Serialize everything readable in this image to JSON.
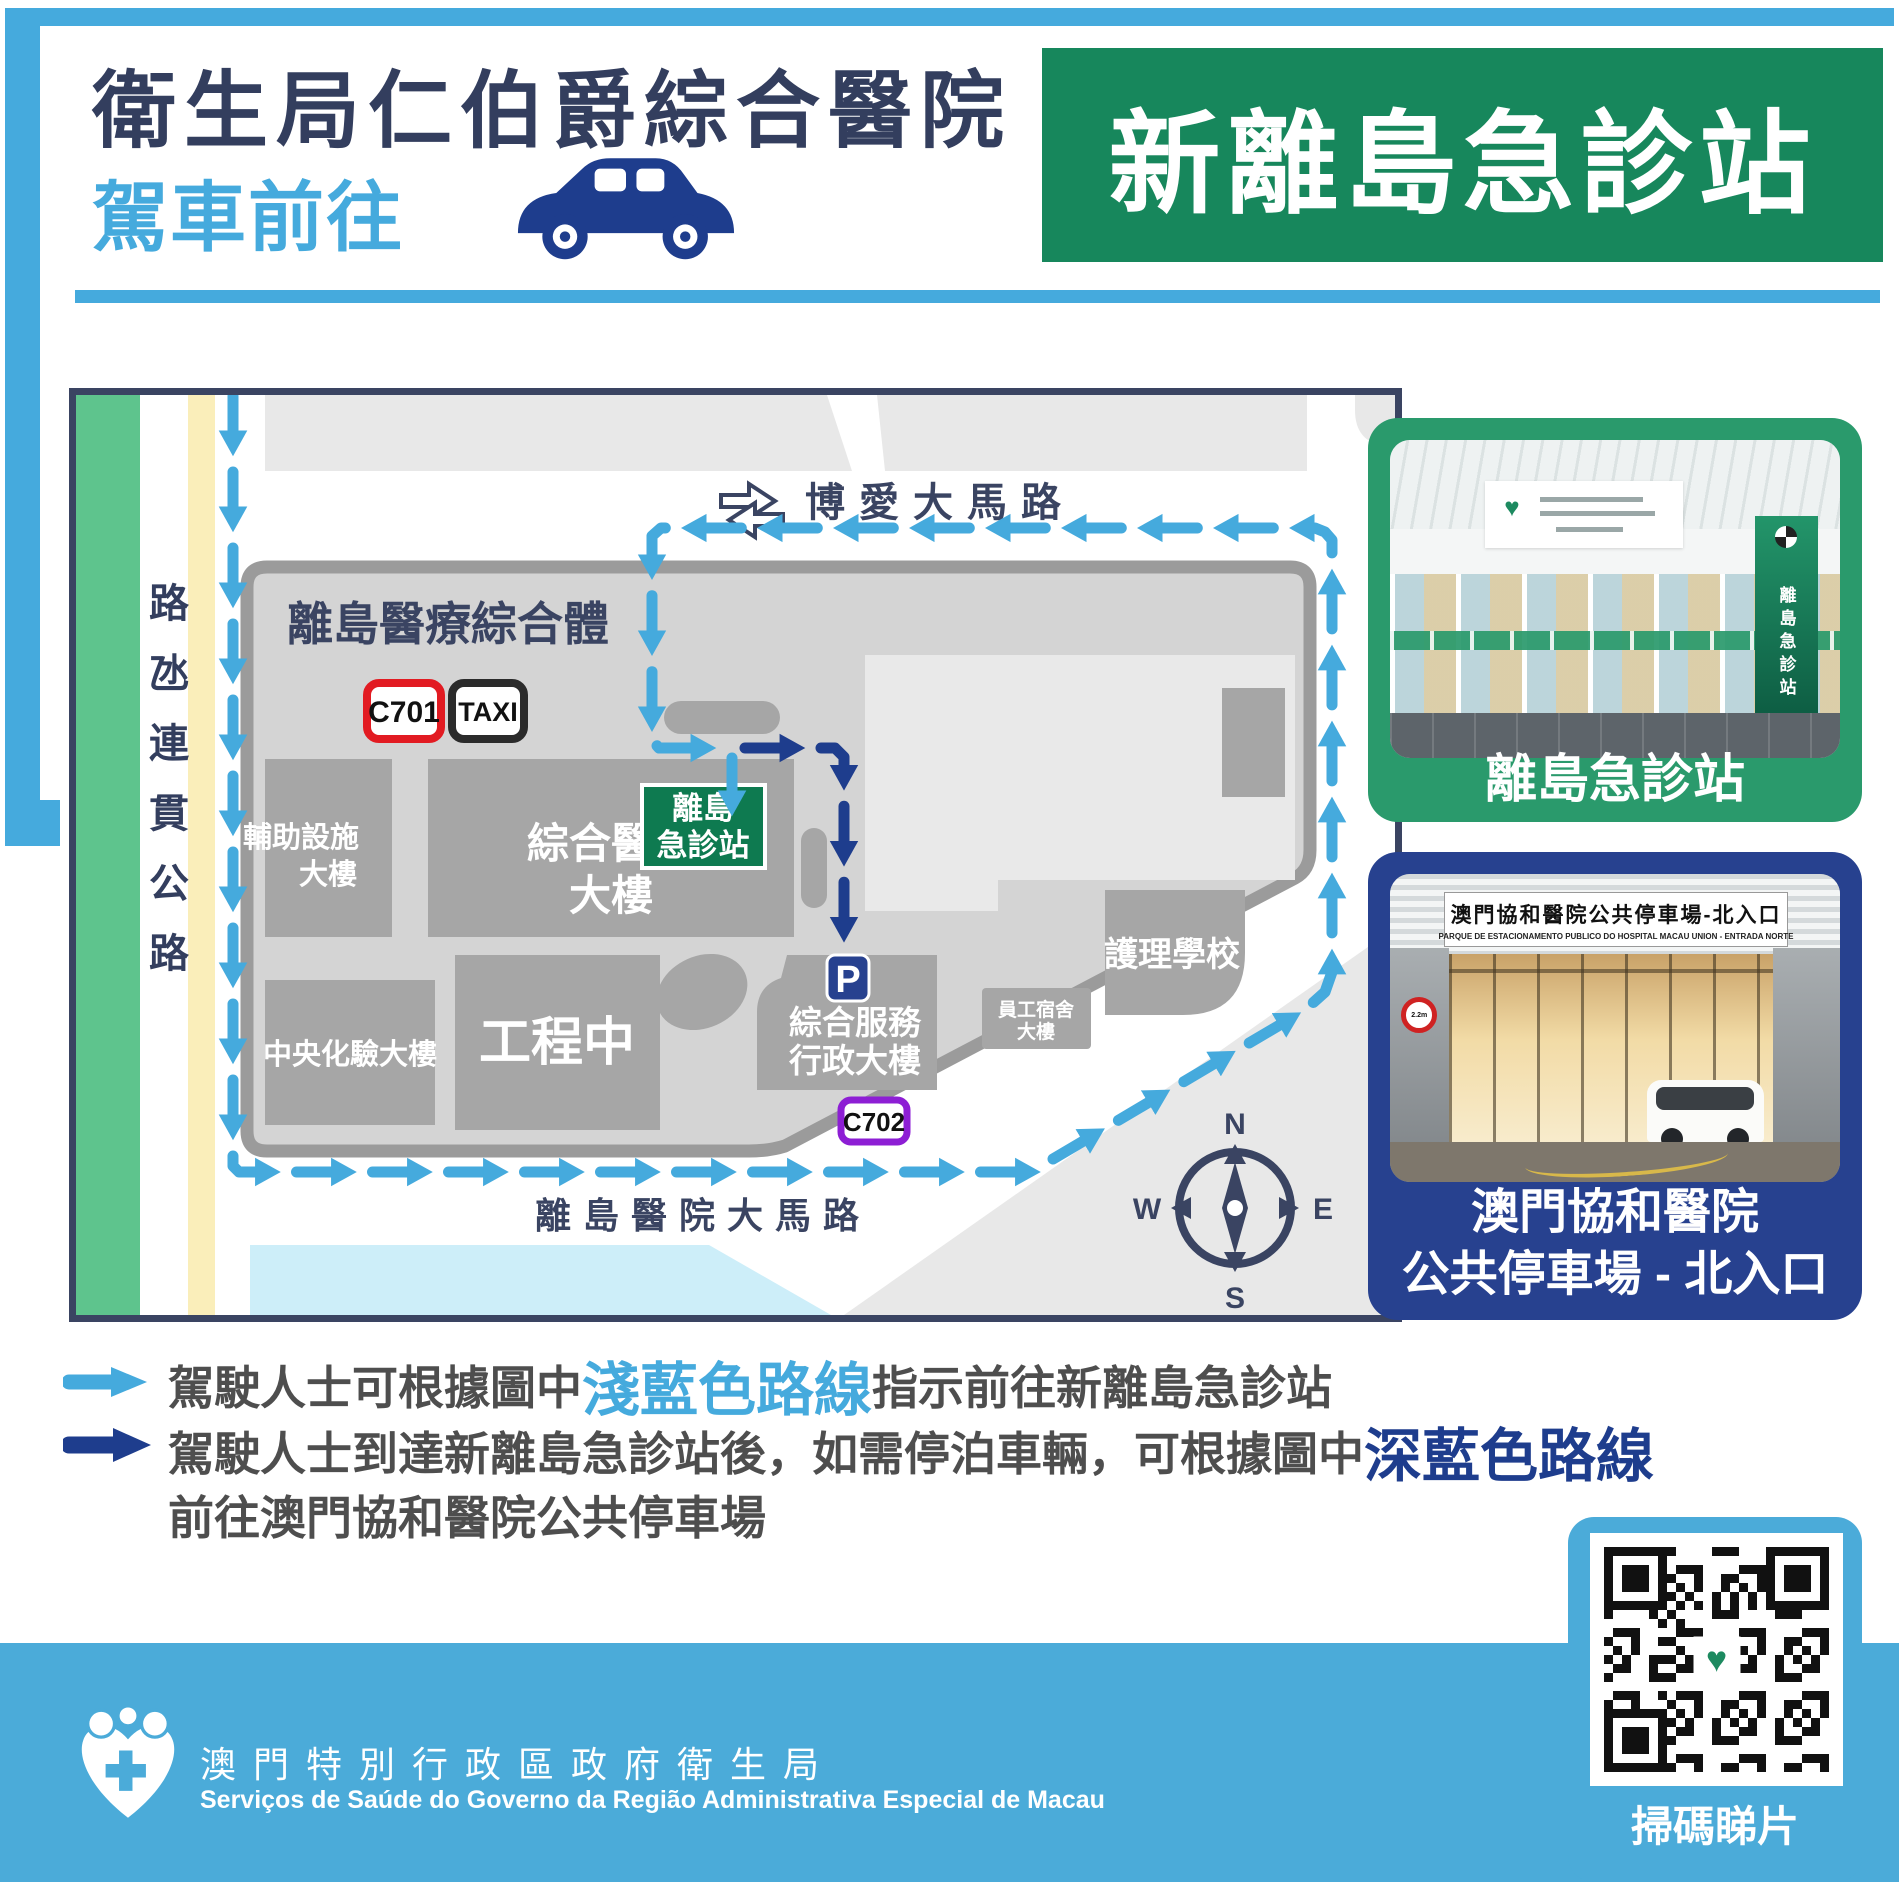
{
  "header": {
    "title": "衛生局仁伯爵綜合醫院",
    "subtitle": "駕車前往",
    "badge": "新離島急診站"
  },
  "map": {
    "roads": {
      "left_vertical": "路氹連貫公路",
      "top": "博愛大馬路",
      "bottom": "離島醫院大馬路"
    },
    "complex_label": "離島醫療綜合體",
    "stops": {
      "c701": "C701",
      "taxi": "TAXI",
      "c702": "C702",
      "parking": "P"
    },
    "buildings": {
      "aux": [
        "輔助設施",
        "大樓"
      ],
      "hospital": [
        "綜合醫院",
        "大樓"
      ],
      "er": [
        "離島",
        "急診站"
      ],
      "lab": "中央化驗大樓",
      "works": "工程中",
      "admin": [
        "綜合服務",
        "行政大樓"
      ],
      "dorm": [
        "員工宿舍",
        "大樓"
      ],
      "nursing": "護理學校"
    },
    "compass": {
      "n": "N",
      "e": "E",
      "s": "S",
      "w": "W"
    }
  },
  "photos": {
    "er": {
      "caption": "離島急診站",
      "panel_text": "離島急診站"
    },
    "parking": {
      "sign_zh": "澳門協和醫院公共停車場-北入口",
      "sign_pt": "PARQUE DE ESTACIONAMENTO PUBLICO DO HOSPITAL MACAU UNION - ENTRADA NORTE",
      "height_sign": "2.2m",
      "caption_line1": "澳門協和醫院",
      "caption_line2": "公共停車場 - 北入口"
    }
  },
  "legend": {
    "line1": {
      "pre": "駕駛人士可根據圖中",
      "hl": "淺藍色路線",
      "post": "指示前往新離島急診站"
    },
    "line2": {
      "pre": "駕駛人士到達新離島急診站後，如需停泊車輛，可根據圖中",
      "hl": "深藍色路線"
    },
    "line3": "前往澳門協和醫院公共停車場"
  },
  "footer": {
    "org_zh": "澳門特別行政區政府衛生局",
    "org_pt": "Serviços de Saúde do Governo da Região Administrativa Especial de Macau",
    "qr_caption": "掃碼睇片"
  },
  "colors": {
    "light_blue": "#45aadd",
    "dark_blue": "#1e3d8d",
    "navy": "#333e5e",
    "green": "#17875c",
    "footer_blue": "#4babd9",
    "red": "#e21b22",
    "purple": "#8d1ed4"
  }
}
